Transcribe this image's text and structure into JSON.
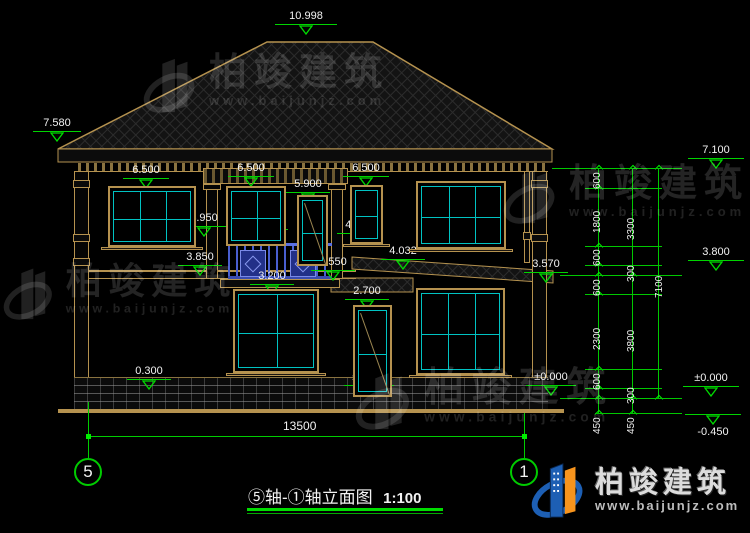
{
  "colors": {
    "bg": "#000000",
    "cad_tan": "#b5924f",
    "cad_cyan": "#00c2c2",
    "dim_green": "#00d400",
    "bright_green": "#00ee00",
    "text_white": "#f2f2f2",
    "rail_blue": "#4a5fd0",
    "logo_blue": "#1d5fb4",
    "logo_orange": "#f7941d",
    "watermark": "rgba(255,255,255,0.14)"
  },
  "title_block": {
    "title": "⑤轴-①轴立面图",
    "scale": "1:100"
  },
  "axes": {
    "left": "5",
    "right": "1"
  },
  "bottom_dim": {
    "value": "13500"
  },
  "watermark": {
    "brand": "柏竣建筑",
    "url": "www.baijunjz.com"
  },
  "logo": {
    "brand": "柏竣建筑",
    "url": "www.baijunjz.com"
  },
  "levels": [
    {
      "t": "10.998",
      "x": 275,
      "y": 10,
      "w": 62
    },
    {
      "t": "7.580",
      "x": 33,
      "y": 117,
      "w": 48
    },
    {
      "t": "6.500",
      "x": 123,
      "y": 164,
      "w": 46
    },
    {
      "t": "6.500",
      "x": 228,
      "y": 162,
      "w": 46
    },
    {
      "t": "6.500",
      "x": 343,
      "y": 162,
      "w": 46
    },
    {
      "t": "5.900",
      "x": 286,
      "y": 178,
      "w": 44
    },
    {
      "t": "4.700",
      "x": 125,
      "y": 219,
      "w": 44
    },
    {
      "t": "4.950",
      "x": 182,
      "y": 212,
      "w": 44
    },
    {
      "t": "4.850",
      "x": 244,
      "y": 215,
      "w": 44
    },
    {
      "t": "4.700",
      "x": 337,
      "y": 219,
      "w": 44
    },
    {
      "t": "4.032",
      "x": 381,
      "y": 245,
      "w": 44
    },
    {
      "t": "3.850",
      "x": 178,
      "y": 251,
      "w": 44
    },
    {
      "t": "3.550",
      "x": 311,
      "y": 256,
      "w": 44
    },
    {
      "t": "3.200",
      "x": 250,
      "y": 270,
      "w": 44
    },
    {
      "t": "3.570",
      "x": 524,
      "y": 258,
      "w": 44
    },
    {
      "t": "2.700",
      "x": 345,
      "y": 285,
      "w": 44
    },
    {
      "t": "0.900",
      "x": 250,
      "y": 341,
      "w": 44
    },
    {
      "t": "0.300",
      "x": 127,
      "y": 365,
      "w": 44
    },
    {
      "t": "±0.000",
      "x": 344,
      "y": 371,
      "w": 50
    },
    {
      "t": "±0.000",
      "x": 526,
      "y": 371,
      "w": 50
    },
    {
      "t": "7.100",
      "x": 688,
      "y": 144,
      "w": 56
    },
    {
      "t": "3.800",
      "x": 688,
      "y": 246,
      "w": 56
    },
    {
      "t": "±0.000",
      "x": 683,
      "y": 372,
      "w": 56
    },
    {
      "t": "-0.450",
      "x": 685,
      "y": 414,
      "w": 56,
      "flip": true
    }
  ],
  "chain_labels": [
    {
      "t": "600",
      "x": 592,
      "y": 189
    },
    {
      "t": "1800",
      "x": 592,
      "y": 233
    },
    {
      "t": "600",
      "x": 592,
      "y": 266
    },
    {
      "t": "600",
      "x": 592,
      "y": 296
    },
    {
      "t": "2300",
      "x": 592,
      "y": 350
    },
    {
      "t": "600",
      "x": 592,
      "y": 390
    },
    {
      "t": "450",
      "x": 592,
      "y": 434
    },
    {
      "t": "3300",
      "x": 626,
      "y": 240
    },
    {
      "t": "300",
      "x": 626,
      "y": 282
    },
    {
      "t": "3800",
      "x": 626,
      "y": 352
    },
    {
      "t": "300",
      "x": 626,
      "y": 404
    },
    {
      "t": "450",
      "x": 626,
      "y": 434
    },
    {
      "t": "7100",
      "x": 654,
      "y": 298
    }
  ],
  "chains": [
    {
      "x": 598,
      "y1": 168,
      "y2": 413,
      "ticks": [
        168,
        188,
        246,
        265,
        275,
        294,
        369,
        388,
        398,
        413
      ]
    },
    {
      "x": 632,
      "y1": 168,
      "y2": 413,
      "ticks": [
        168,
        275,
        398,
        413
      ]
    },
    {
      "x": 658,
      "y1": 168,
      "y2": 398,
      "ticks": [
        168,
        398
      ]
    }
  ],
  "ext_lines": [
    {
      "x1": 552,
      "x2": 682,
      "y": 168
    },
    {
      "x1": 585,
      "x2": 662,
      "y": 188
    },
    {
      "x1": 585,
      "x2": 662,
      "y": 246
    },
    {
      "x1": 585,
      "x2": 662,
      "y": 265
    },
    {
      "x1": 560,
      "x2": 682,
      "y": 275
    },
    {
      "x1": 585,
      "x2": 662,
      "y": 294
    },
    {
      "x1": 585,
      "x2": 662,
      "y": 369
    },
    {
      "x1": 585,
      "x2": 662,
      "y": 388
    },
    {
      "x1": 560,
      "x2": 682,
      "y": 398
    },
    {
      "x1": 595,
      "x2": 682,
      "y": 413
    }
  ],
  "windows": [
    {
      "x": 108,
      "y": 186,
      "w": 88,
      "h": 61,
      "cols": 3,
      "rows": 2,
      "sill": true
    },
    {
      "x": 226,
      "y": 186,
      "w": 60,
      "h": 60,
      "cols": 2,
      "rows": 2,
      "sill": false
    },
    {
      "x": 350,
      "y": 185,
      "w": 33,
      "h": 59,
      "cols": 1,
      "rows": 2,
      "sill": true
    },
    {
      "x": 416,
      "y": 181,
      "w": 90,
      "h": 68,
      "cols": 3,
      "rows": 2,
      "sill": true
    },
    {
      "x": 233,
      "y": 289,
      "w": 86,
      "h": 84,
      "cols": 2,
      "rows": 2,
      "sill": true
    },
    {
      "x": 416,
      "y": 288,
      "w": 89,
      "h": 87,
      "cols": 3,
      "rows": 2,
      "sill": true
    },
    {
      "x": 297,
      "y": 195,
      "w": 31,
      "h": 71,
      "cols": 1,
      "rows": 2,
      "door": true
    },
    {
      "x": 353,
      "y": 305,
      "w": 39,
      "h": 92,
      "cols": 1,
      "rows": 2,
      "door": true
    }
  ],
  "watermarks_pos": [
    {
      "x": 143,
      "y": 52,
      "s": 1.0
    },
    {
      "x": 503,
      "y": 163,
      "s": 1.0
    },
    {
      "x": 3,
      "y": 262,
      "s": 0.95
    },
    {
      "x": 355,
      "y": 366,
      "s": 1.05
    }
  ]
}
